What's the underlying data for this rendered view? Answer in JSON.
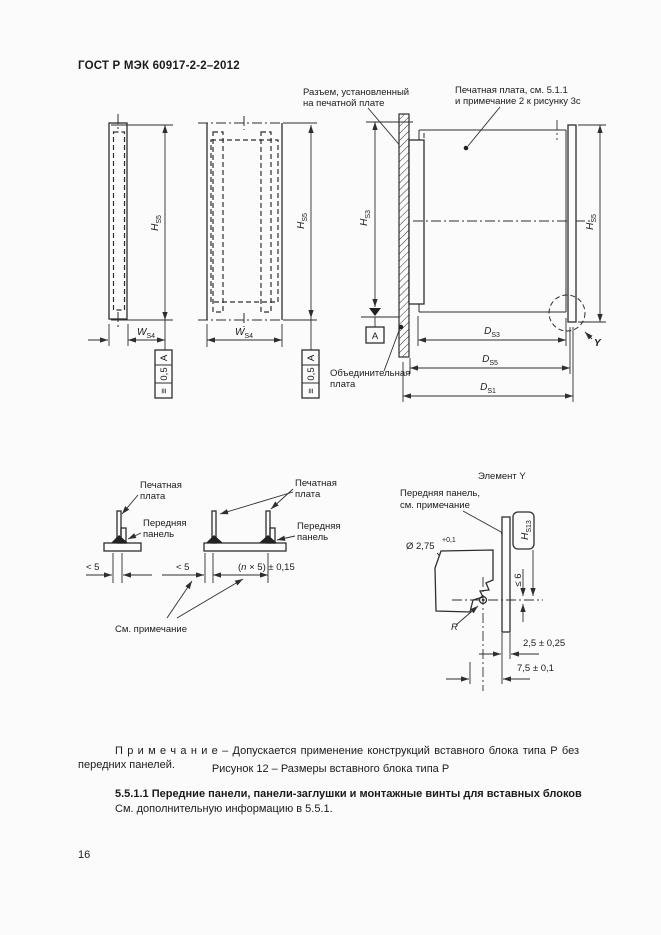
{
  "doc": {
    "header": "ГОСТ Р МЭК 60917-2-2–2012",
    "note": "П р и м е ч а н и е  –  Допускается применение конструкций вставного блока типа Р без передних панелей.",
    "figure_caption": "Рисунок 12 – Размеры вставного блока типа Р",
    "section_heading": "5.5.1.1 Передние панели, панели-заглушки и монтажные винты для вставных блоков",
    "section_text": "См. дополнительную информацию в 5.5.1.",
    "page_number": "16"
  },
  "figure_top": {
    "callout_connector": {
      "line1": "Разъем, установленный",
      "line2": "на печатной плате"
    },
    "callout_pcb": {
      "line1": "Печатная плата, см. 5.1.1",
      "line2": "и примечание 2 к рисунку 3c"
    },
    "callout_backplane": {
      "line1": "Объединительная",
      "line2": "плата"
    },
    "datum_label": "A",
    "tolerance": {
      "symbol": "≡",
      "value": "0,5",
      "datum": "A"
    },
    "detail_ref": "Y",
    "dims": {
      "hs5": {
        "base": "H",
        "sub": "S5"
      },
      "hs3": {
        "base": "H",
        "sub": "S3"
      },
      "ws4": {
        "base": "W",
        "sub": "S4"
      },
      "ds3": {
        "base": "D",
        "sub": "S3"
      },
      "ds5": {
        "base": "D",
        "sub": "S5"
      },
      "ds1": {
        "base": "D",
        "sub": "S1"
      }
    }
  },
  "figure_bottom": {
    "label_pcb": {
      "line1": "Печатная",
      "line2": "плата"
    },
    "label_panel": {
      "line1": "Передняя",
      "line2": "панель"
    },
    "see_note": "См. примечание",
    "dim_lt5": "< 5",
    "dim_pitch": {
      "pre": "(",
      "n": "n",
      "post": " × 5) ± 0,15"
    },
    "element_y": {
      "title": "Элемент Y",
      "panel_note": {
        "line1": "Передняя панель,",
        "line2": "см. примечание"
      },
      "dia": "Ø 2,75",
      "dia_tol_plus": "+0,1",
      "dia_tol_zero": "0",
      "dim_le6": "≤ 6",
      "radius_label": "R",
      "dim_thickness": "2,5 ± 0,25",
      "dim_offset": "7,5 ± 0,1",
      "hs13": {
        "base": "H",
        "sub": "S13"
      }
    }
  }
}
